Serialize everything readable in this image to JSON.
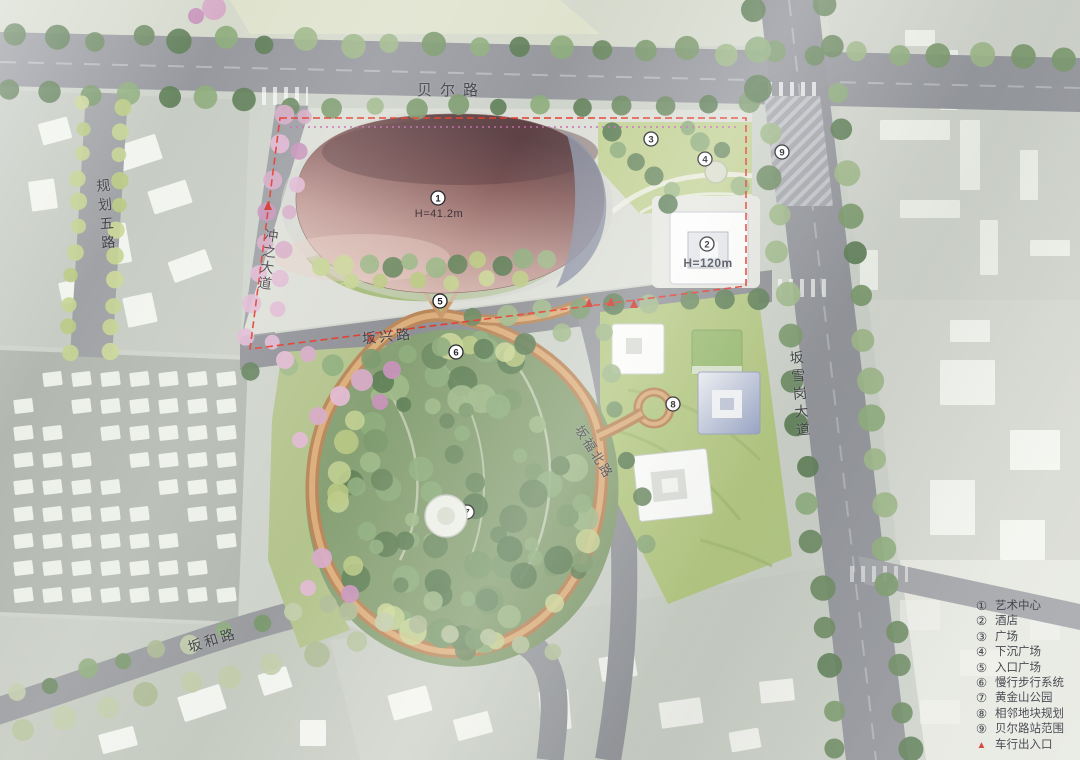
{
  "map": {
    "road_labels": {
      "beier": "贝尔路",
      "guihua": "规划五路",
      "chongzhi": "冲之大道",
      "banxing": "坂兴路",
      "banfu": "坂福北路",
      "banxuegang": "坂雪岗大道",
      "banhe": "坂和路"
    },
    "building_labels": {
      "art_center": "H=41.2m",
      "hotel": "H=120m"
    },
    "markers": [
      "1",
      "2",
      "3",
      "4",
      "5",
      "6",
      "7",
      "8",
      "9"
    ]
  },
  "legend": {
    "items": [
      {
        "symbol": "①",
        "label": "艺术中心"
      },
      {
        "symbol": "②",
        "label": "酒店"
      },
      {
        "symbol": "③",
        "label": "广场"
      },
      {
        "symbol": "④",
        "label": "下沉广场"
      },
      {
        "symbol": "⑤",
        "label": "入口广场"
      },
      {
        "symbol": "⑥",
        "label": "慢行步行系统"
      },
      {
        "symbol": "⑦",
        "label": "黄金山公园"
      },
      {
        "symbol": "⑧",
        "label": "相邻地块规划"
      },
      {
        "symbol": "⑨",
        "label": "贝尔路站范围"
      },
      {
        "symbol": "▲",
        "label": "车行出入口"
      }
    ]
  },
  "colors": {
    "boundary_red": "#e23a2b",
    "entrance_red": "#d03227",
    "walkway_tan": "#b9875a",
    "art_center_pink": "#b78b88",
    "metro_magenta": "#c468b0"
  }
}
